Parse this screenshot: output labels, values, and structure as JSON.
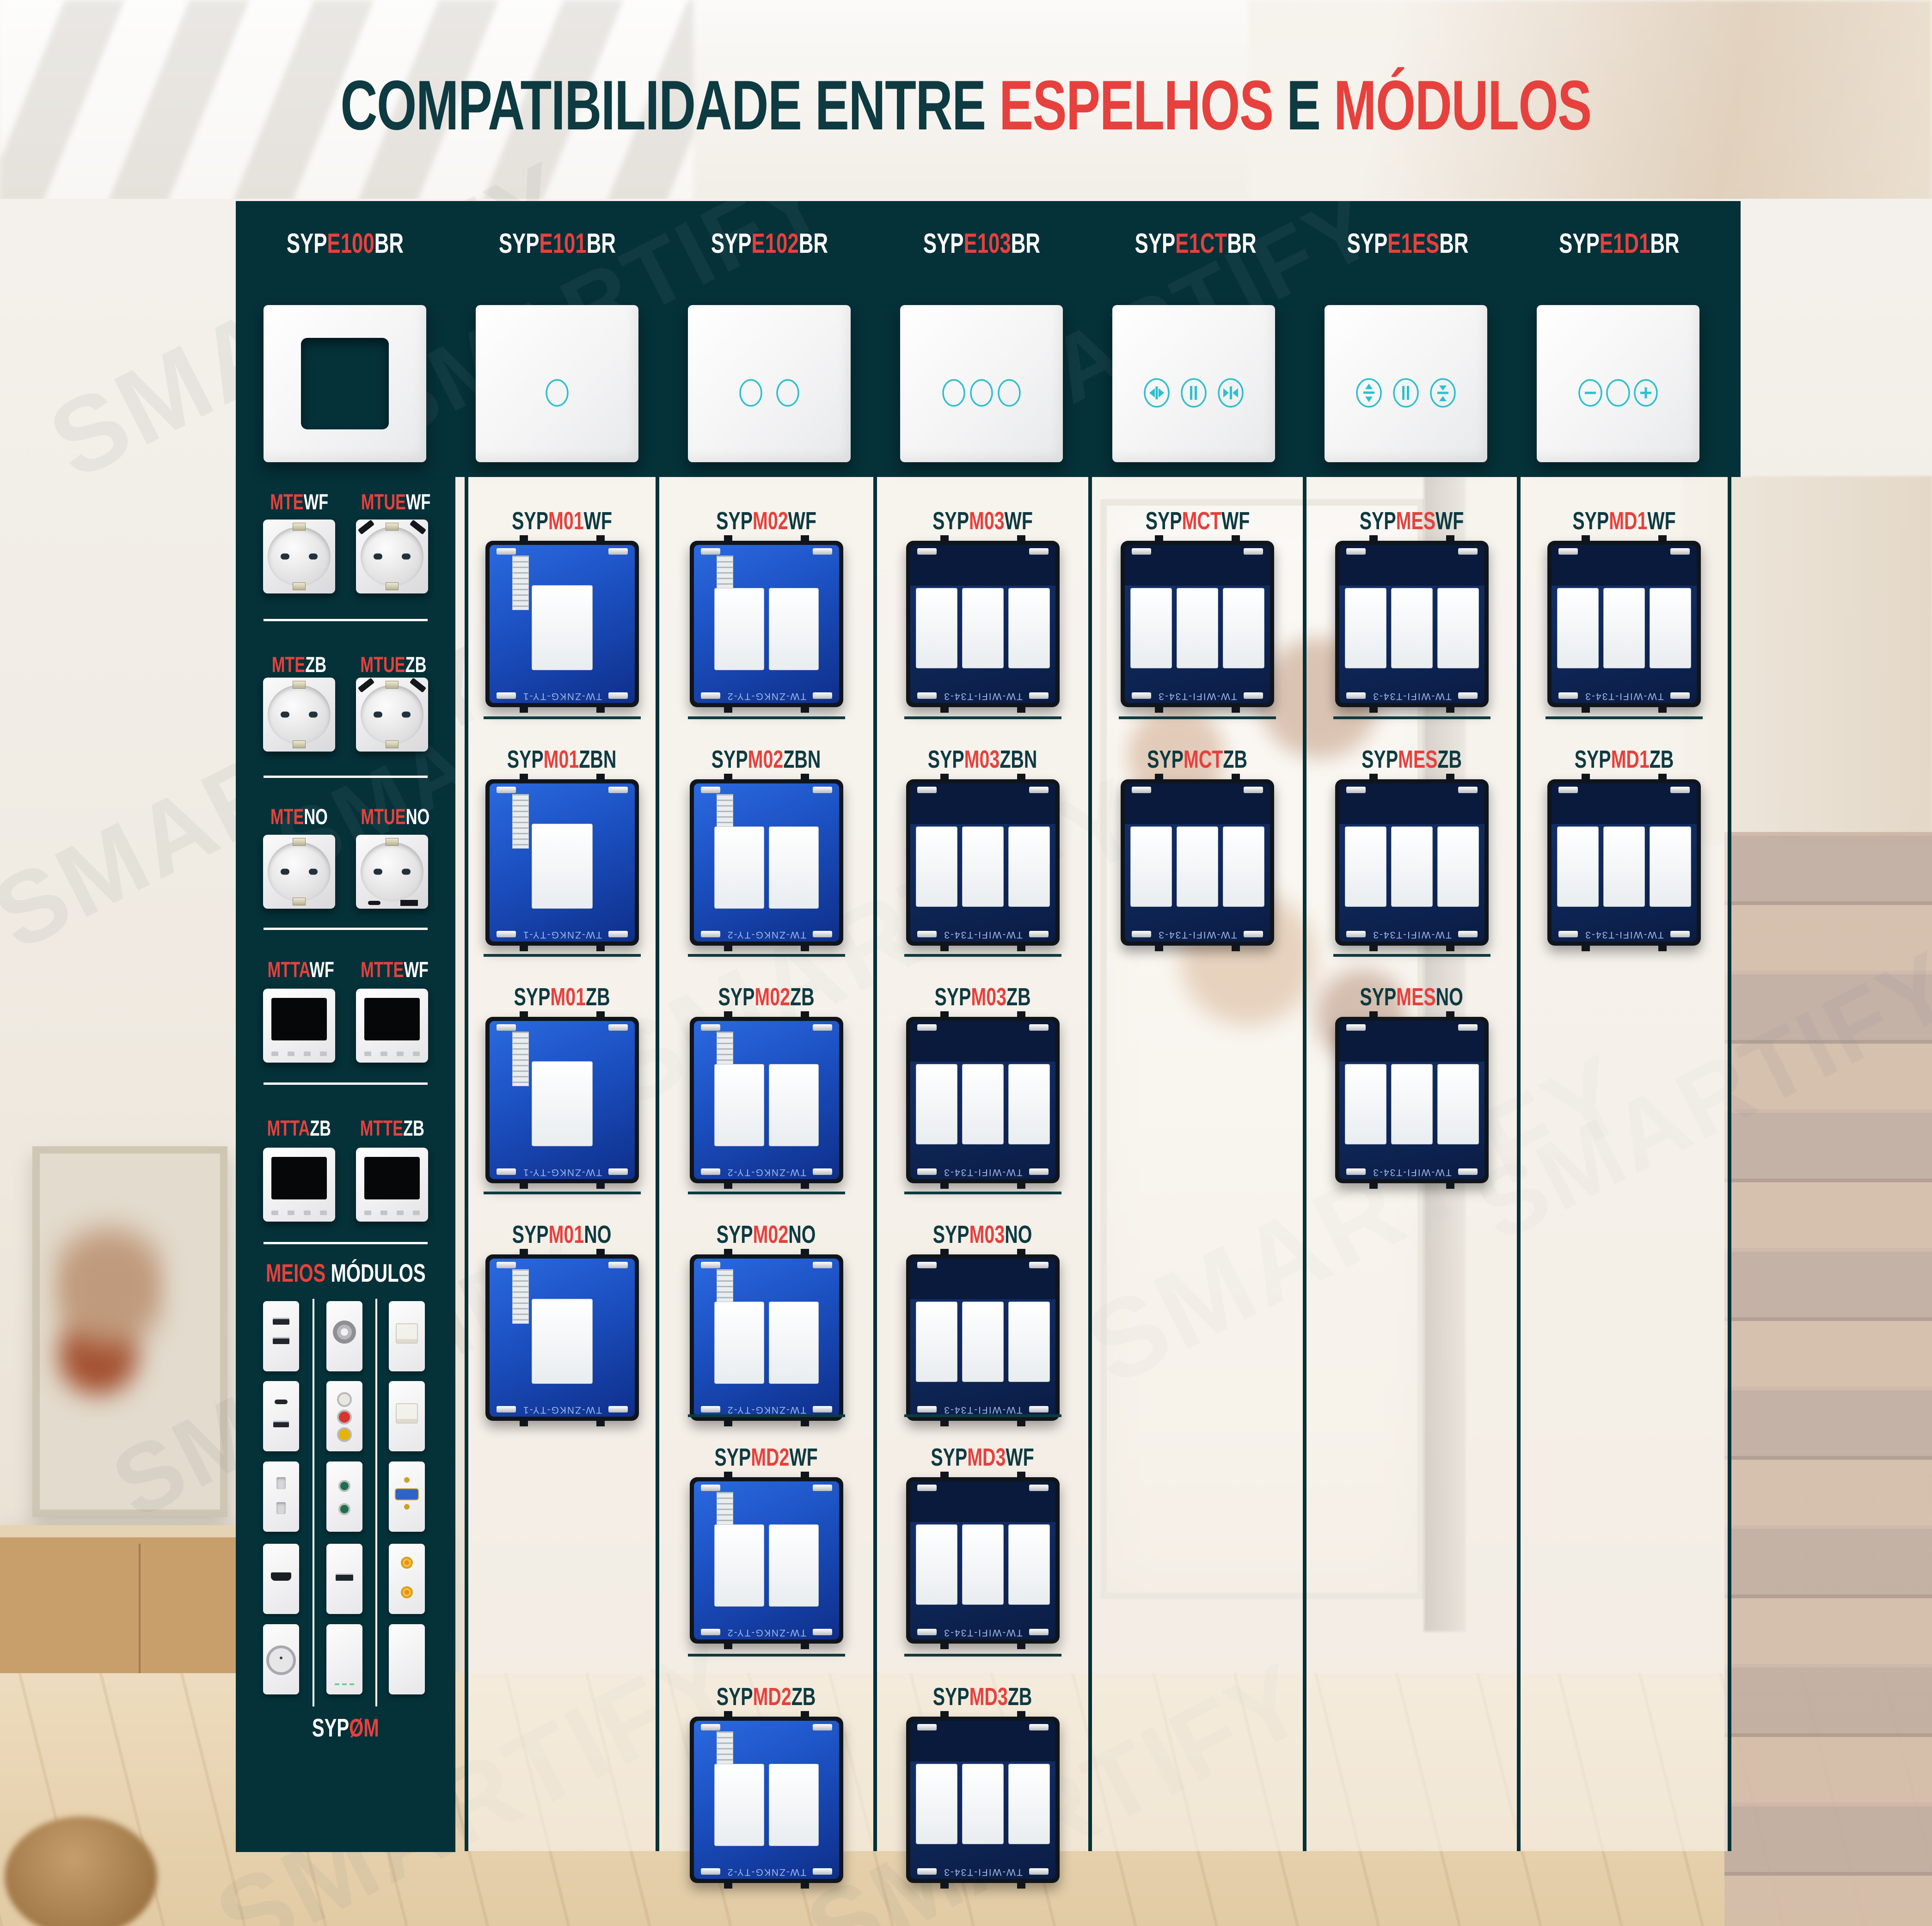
{
  "title": {
    "prefix": "COMPATIBILIDADE ENTRE",
    "accent1": "ESPELHOS",
    "conjunction": "E",
    "accent2": "MÓDULOS"
  },
  "watermark": "SMARTIFY",
  "colors": {
    "panel_teal": "#053139",
    "accent_red": "#e6413d",
    "label_teal_dark": "#0e3a41",
    "icon_teal": "#2cc0cd"
  },
  "header": {
    "plates": [
      {
        "prefix": "SYP",
        "code": "E100",
        "suffix": "BR",
        "icon": "empty-frame"
      },
      {
        "prefix": "SYP",
        "code": "E101",
        "suffix": "BR",
        "icon": "touch-1-circle"
      },
      {
        "prefix": "SYP",
        "code": "E102",
        "suffix": "BR",
        "icon": "touch-2-circles"
      },
      {
        "prefix": "SYP",
        "code": "E103",
        "suffix": "BR",
        "icon": "touch-3-circles"
      },
      {
        "prefix": "SYP",
        "code": "E1CT",
        "suffix": "BR",
        "icon": "curtain-open-pause-close"
      },
      {
        "prefix": "SYP",
        "code": "E1ES",
        "suffix": "BR",
        "icon": "shutter-up-pause-down"
      },
      {
        "prefix": "SYP",
        "code": "E1D1",
        "suffix": "BR",
        "icon": "dimmer-minus-circle-plus"
      }
    ]
  },
  "sidebar": {
    "groups": [
      {
        "items": [
          {
            "accent": "MTE",
            "rest": "WF",
            "kind": "socket"
          },
          {
            "accent": "MTUE",
            "rest": "WF",
            "kind": "socket-usb"
          }
        ]
      },
      {
        "items": [
          {
            "accent": "MTE",
            "rest": "ZB",
            "kind": "socket"
          },
          {
            "accent": "MTUE",
            "rest": "ZB",
            "kind": "socket-usb"
          }
        ]
      },
      {
        "items": [
          {
            "accent": "MTE",
            "rest": "NO",
            "kind": "socket"
          },
          {
            "accent": "MTUE",
            "rest": "NO",
            "kind": "socket-usb-c"
          }
        ]
      },
      {
        "items": [
          {
            "accent": "MTTA",
            "rest": "WF",
            "kind": "thermostat"
          },
          {
            "accent": "MTTE",
            "rest": "WF",
            "kind": "thermostat"
          }
        ]
      },
      {
        "items": [
          {
            "accent": "MTTA",
            "rest": "ZB",
            "kind": "thermostat"
          },
          {
            "accent": "MTTE",
            "rest": "ZB",
            "kind": "thermostat"
          }
        ]
      }
    ],
    "half_modules": {
      "title_accent": "MEIOS",
      "title_rest": "MÓDULOS",
      "grid": [
        [
          "usb-double",
          "sat-connector",
          "rj45"
        ],
        [
          "usb-c-plus-a",
          "rca-triple",
          "rj45"
        ],
        [
          "two-pin-socket",
          "jack-double",
          "vga"
        ],
        [
          "hdmi",
          "usb-data",
          "rca-gold-double"
        ],
        [
          "coax-tv",
          "blank-led",
          "blank"
        ]
      ],
      "footer": {
        "prefix": "SYP",
        "accent": "ØM"
      }
    }
  },
  "columns": [
    {
      "marking": "TW-ZNKG-TY-1",
      "rows": [
        {
          "prefix": "SYP",
          "accent": "M01",
          "rest": "WF"
        },
        {
          "prefix": "SYP",
          "accent": "M01",
          "rest": "ZBN"
        },
        {
          "prefix": "SYP",
          "accent": "M01",
          "rest": "ZB"
        },
        {
          "prefix": "SYP",
          "accent": "M01",
          "rest": "NO"
        }
      ]
    },
    {
      "marking": "TW-ZNKG-TY-2",
      "rows": [
        {
          "prefix": "SYP",
          "accent": "M02",
          "rest": "WF"
        },
        {
          "prefix": "SYP",
          "accent": "M02",
          "rest": "ZBN"
        },
        {
          "prefix": "SYP",
          "accent": "M02",
          "rest": "ZB"
        },
        {
          "prefix": "SYP",
          "accent": "M02",
          "rest": "NO"
        },
        {
          "prefix": "SYP",
          "accent": "MD2",
          "rest": "WF"
        },
        {
          "prefix": "SYP",
          "accent": "MD2",
          "rest": "ZB"
        }
      ]
    },
    {
      "marking": "TW-WIFI-T34-3",
      "rows": [
        {
          "prefix": "SYP",
          "accent": "M03",
          "rest": "WF"
        },
        {
          "prefix": "SYP",
          "accent": "M03",
          "rest": "ZBN"
        },
        {
          "prefix": "SYP",
          "accent": "M03",
          "rest": "ZB"
        },
        {
          "prefix": "SYP",
          "accent": "M03",
          "rest": "NO"
        },
        {
          "prefix": "SYP",
          "accent": "MD3",
          "rest": "WF"
        },
        {
          "prefix": "SYP",
          "accent": "MD3",
          "rest": "ZB"
        }
      ]
    },
    {
      "marking": "TW-WIFI-T34-3",
      "rows": [
        {
          "prefix": "SYP",
          "accent": "MCT",
          "rest": "WF"
        },
        {
          "prefix": "SYP",
          "accent": "MCT",
          "rest": "ZB"
        }
      ]
    },
    {
      "marking": "TW-WIFI-T34-3",
      "rows": [
        {
          "prefix": "SYP",
          "accent": "MES",
          "rest": "WF"
        },
        {
          "prefix": "SYP",
          "accent": "MES",
          "rest": "ZB"
        },
        {
          "prefix": "SYP",
          "accent": "MES",
          "rest": "NO"
        }
      ]
    },
    {
      "marking": "TW-WIFI-T34-3",
      "rows": [
        {
          "prefix": "SYP",
          "accent": "MD1",
          "rest": "WF"
        },
        {
          "prefix": "SYP",
          "accent": "MD1",
          "rest": "ZB"
        }
      ]
    }
  ]
}
